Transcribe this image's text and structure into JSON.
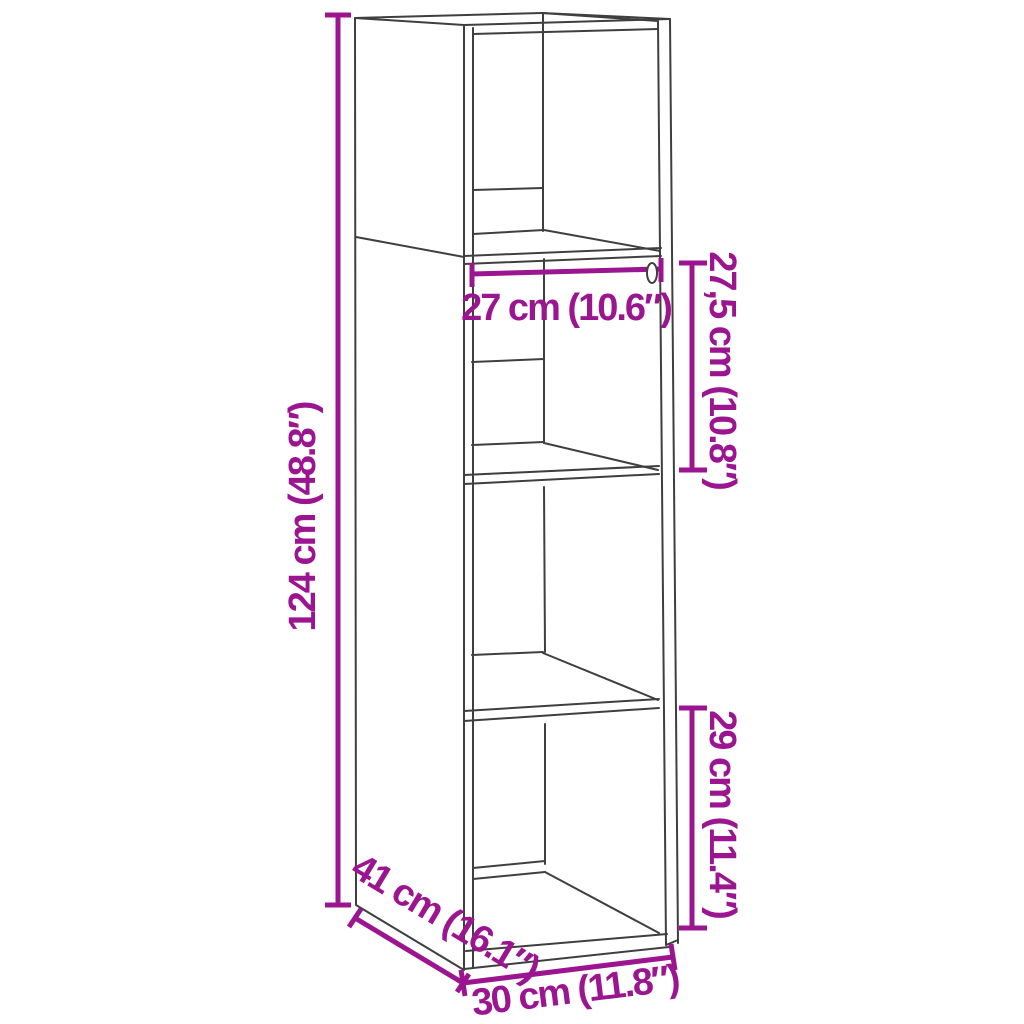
{
  "diagram": {
    "type": "furniture-dimension-diagram",
    "subject": "tall open cabinet with four compartments, 3D perspective line drawing",
    "style": {
      "dimension_color": "#9C1590",
      "outline_color": "#3F3F3F",
      "background": "#FFFFFF"
    },
    "dimensions": {
      "height": {
        "label": "124 cm (48.8″)",
        "value_cm": 124,
        "value_in": 48.8,
        "orientation": "vertical",
        "position": "left of cabinet"
      },
      "inner_width": {
        "label": "27 cm (10.6″)",
        "value_cm": 27,
        "value_in": 10.6,
        "orientation": "horizontal",
        "position": "inside second compartment"
      },
      "upper_compartment": {
        "label": "27,5 cm (10.8″)",
        "value_cm": 27.5,
        "value_in": 10.8,
        "orientation": "vertical",
        "position": "right of second compartment"
      },
      "lower_compartment": {
        "label": "29 cm (11.4″)",
        "value_cm": 29,
        "value_in": 11.4,
        "orientation": "vertical",
        "position": "right of bottom compartment"
      },
      "depth": {
        "label": "41 cm (16.1″)",
        "value_cm": 41,
        "value_in": 16.1,
        "orientation": "diagonal",
        "position": "bottom left, along depth edge"
      },
      "width": {
        "label": "30 cm (11.8″)",
        "value_cm": 30,
        "value_in": 11.8,
        "orientation": "horizontal",
        "position": "bottom front edge"
      }
    }
  }
}
